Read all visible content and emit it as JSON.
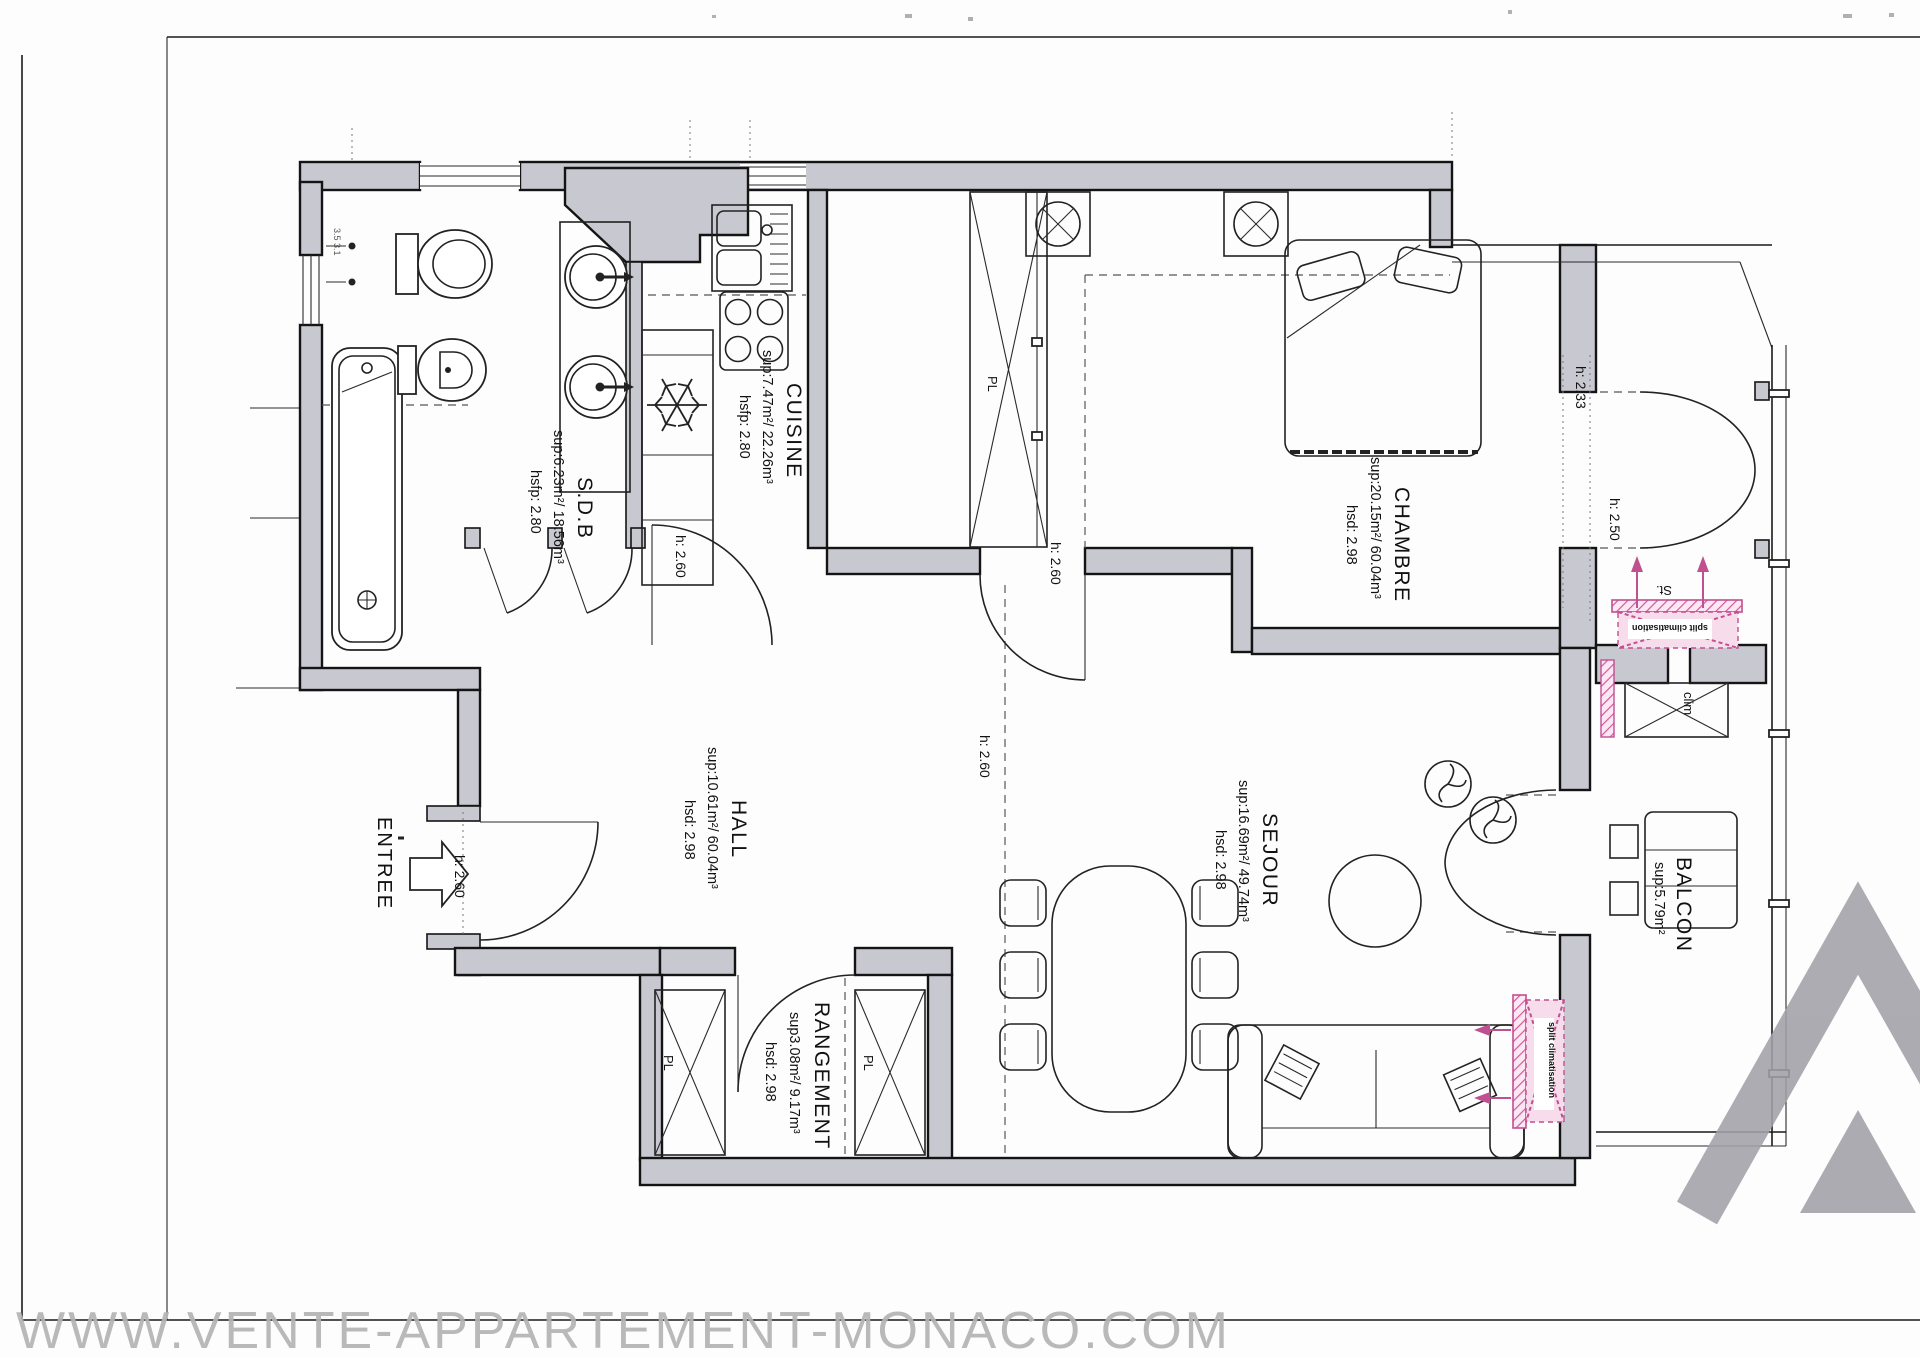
{
  "watermark": "WWW.VENTE-APPARTEMENT-MONACO.COM",
  "rooms": {
    "cuisine": {
      "name": "CUISINE",
      "dims": "sup:7.47m²/ 22.26m³",
      "height": "hsfp: 2.80"
    },
    "sdb": {
      "name": "S.D.B",
      "dims": "sup:6.23m²/ 18.56m³",
      "height": "hsfp: 2.80"
    },
    "chambre": {
      "name": "CHAMBRE",
      "dims": "sup:20.15m²/ 60.04m³",
      "height": "hsd: 2.98"
    },
    "hall": {
      "name": "HALL",
      "dims": "sup:10.61m²/ 60.04m³",
      "height": "hsd: 2.98"
    },
    "sejour": {
      "name": "SEJOUR",
      "dims": "sup:16.69m²/ 49.74m³",
      "height": "hsd: 2.98"
    },
    "rangement": {
      "name": "RANGEMENT",
      "dims": "sup3.08m²/ 9.17m³",
      "height": "hsd: 2.98"
    },
    "balcon": {
      "name": "BALCON",
      "dims": "sup:5.79m²"
    }
  },
  "annotations": {
    "entree": "ENTREE",
    "door_height": "h: 2.60",
    "balcony_height_top": "h: 2.33",
    "balcony_height_mid": "h: 2.50",
    "closet": "PL",
    "duct": "St.",
    "clim": "clim",
    "split_clim": "split climatisation",
    "wall_marks": "3.5 3.1"
  },
  "colors": {
    "accent_pink": "#c0508f",
    "wall_gray": "#c8c8d0",
    "watermark_gray": "#b4b4b4"
  }
}
